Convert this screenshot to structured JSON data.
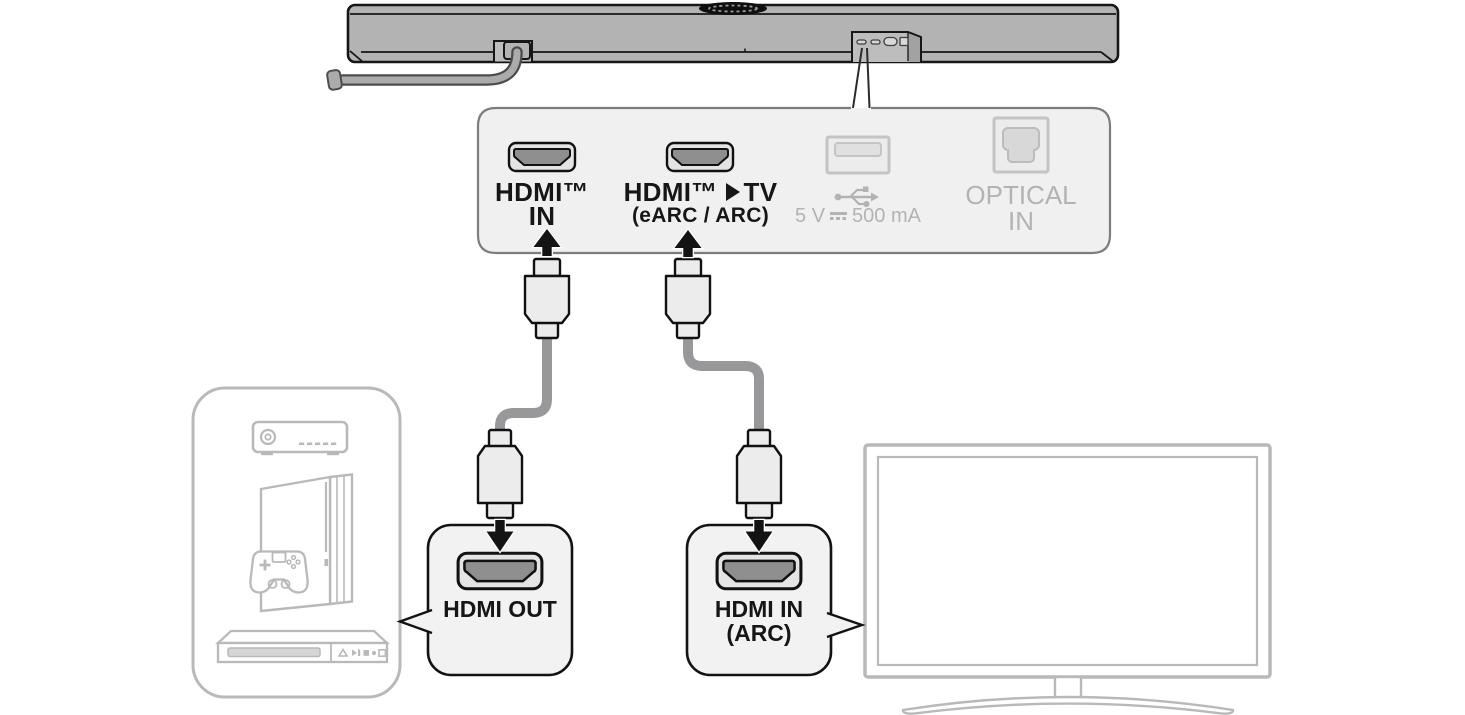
{
  "diagram_type": "soundbar-hdmi-connection-diagram",
  "colors": {
    "line_dark": "#161616",
    "soundbar_gray": "#b3b3b3",
    "panel_fill": "#f0f0f0",
    "panel_border": "#7d7d7d",
    "muted_gray": "#b9b9b9",
    "muted_label": "#b3b3b3",
    "cable_gray": "#98989a",
    "port_dark": "#8f8f8f"
  },
  "icons": {
    "usb": "usb-trident-icon",
    "dc_power": "dc-symbol-icon",
    "hdmi_tv_triangle": "triangle-right-icon",
    "hdmi_port": "hdmi-port-icon",
    "optical_port": "optical-port-icon"
  },
  "panel": {
    "hdmi_in": {
      "line1": "HDMI™",
      "line2": "IN"
    },
    "hdmi_tv": {
      "line1_prefix": "HDMI™",
      "line1_suffix": "TV",
      "line2": "(eARC / ARC)"
    },
    "usb": {
      "power_prefix": "5 V",
      "power_suffix": "500 mA"
    },
    "optical": {
      "line1": "OPTICAL",
      "line2": "IN"
    }
  },
  "source_device_callout": {
    "label": "HDMI OUT"
  },
  "tv_callout": {
    "line1": "HDMI IN",
    "line2": "(ARC)"
  }
}
